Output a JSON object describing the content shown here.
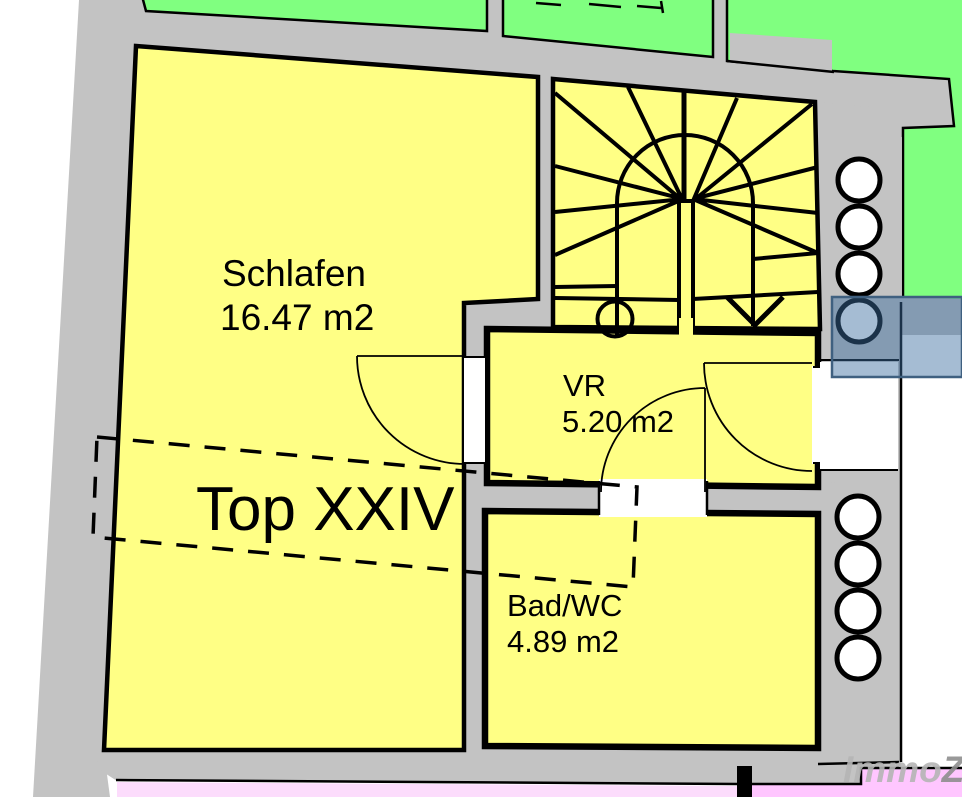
{
  "plan": {
    "unit_label": "Top XXIV",
    "rooms": [
      {
        "name": "Schlafen",
        "area": "16.47 m2"
      },
      {
        "name": "VR",
        "area": "5.20 m2"
      },
      {
        "name": "Bad/WC",
        "area": "4.89 m2"
      }
    ],
    "watermark": {
      "part1": "Immo",
      "part2": "Z"
    },
    "colors": {
      "room_fill": "#ffff85",
      "wall_fill": "#c3c3c3",
      "green_fill": "#80ff80",
      "pink_bottom": "#fcdcfc",
      "pink_right": "#ffc6ff",
      "selection_fill": "rgba(58,108,160,0.46)",
      "selection_border": "#3f6080",
      "watermark_color": "#b5b5b5",
      "watermark_z_color": "#8e8e8e"
    }
  }
}
